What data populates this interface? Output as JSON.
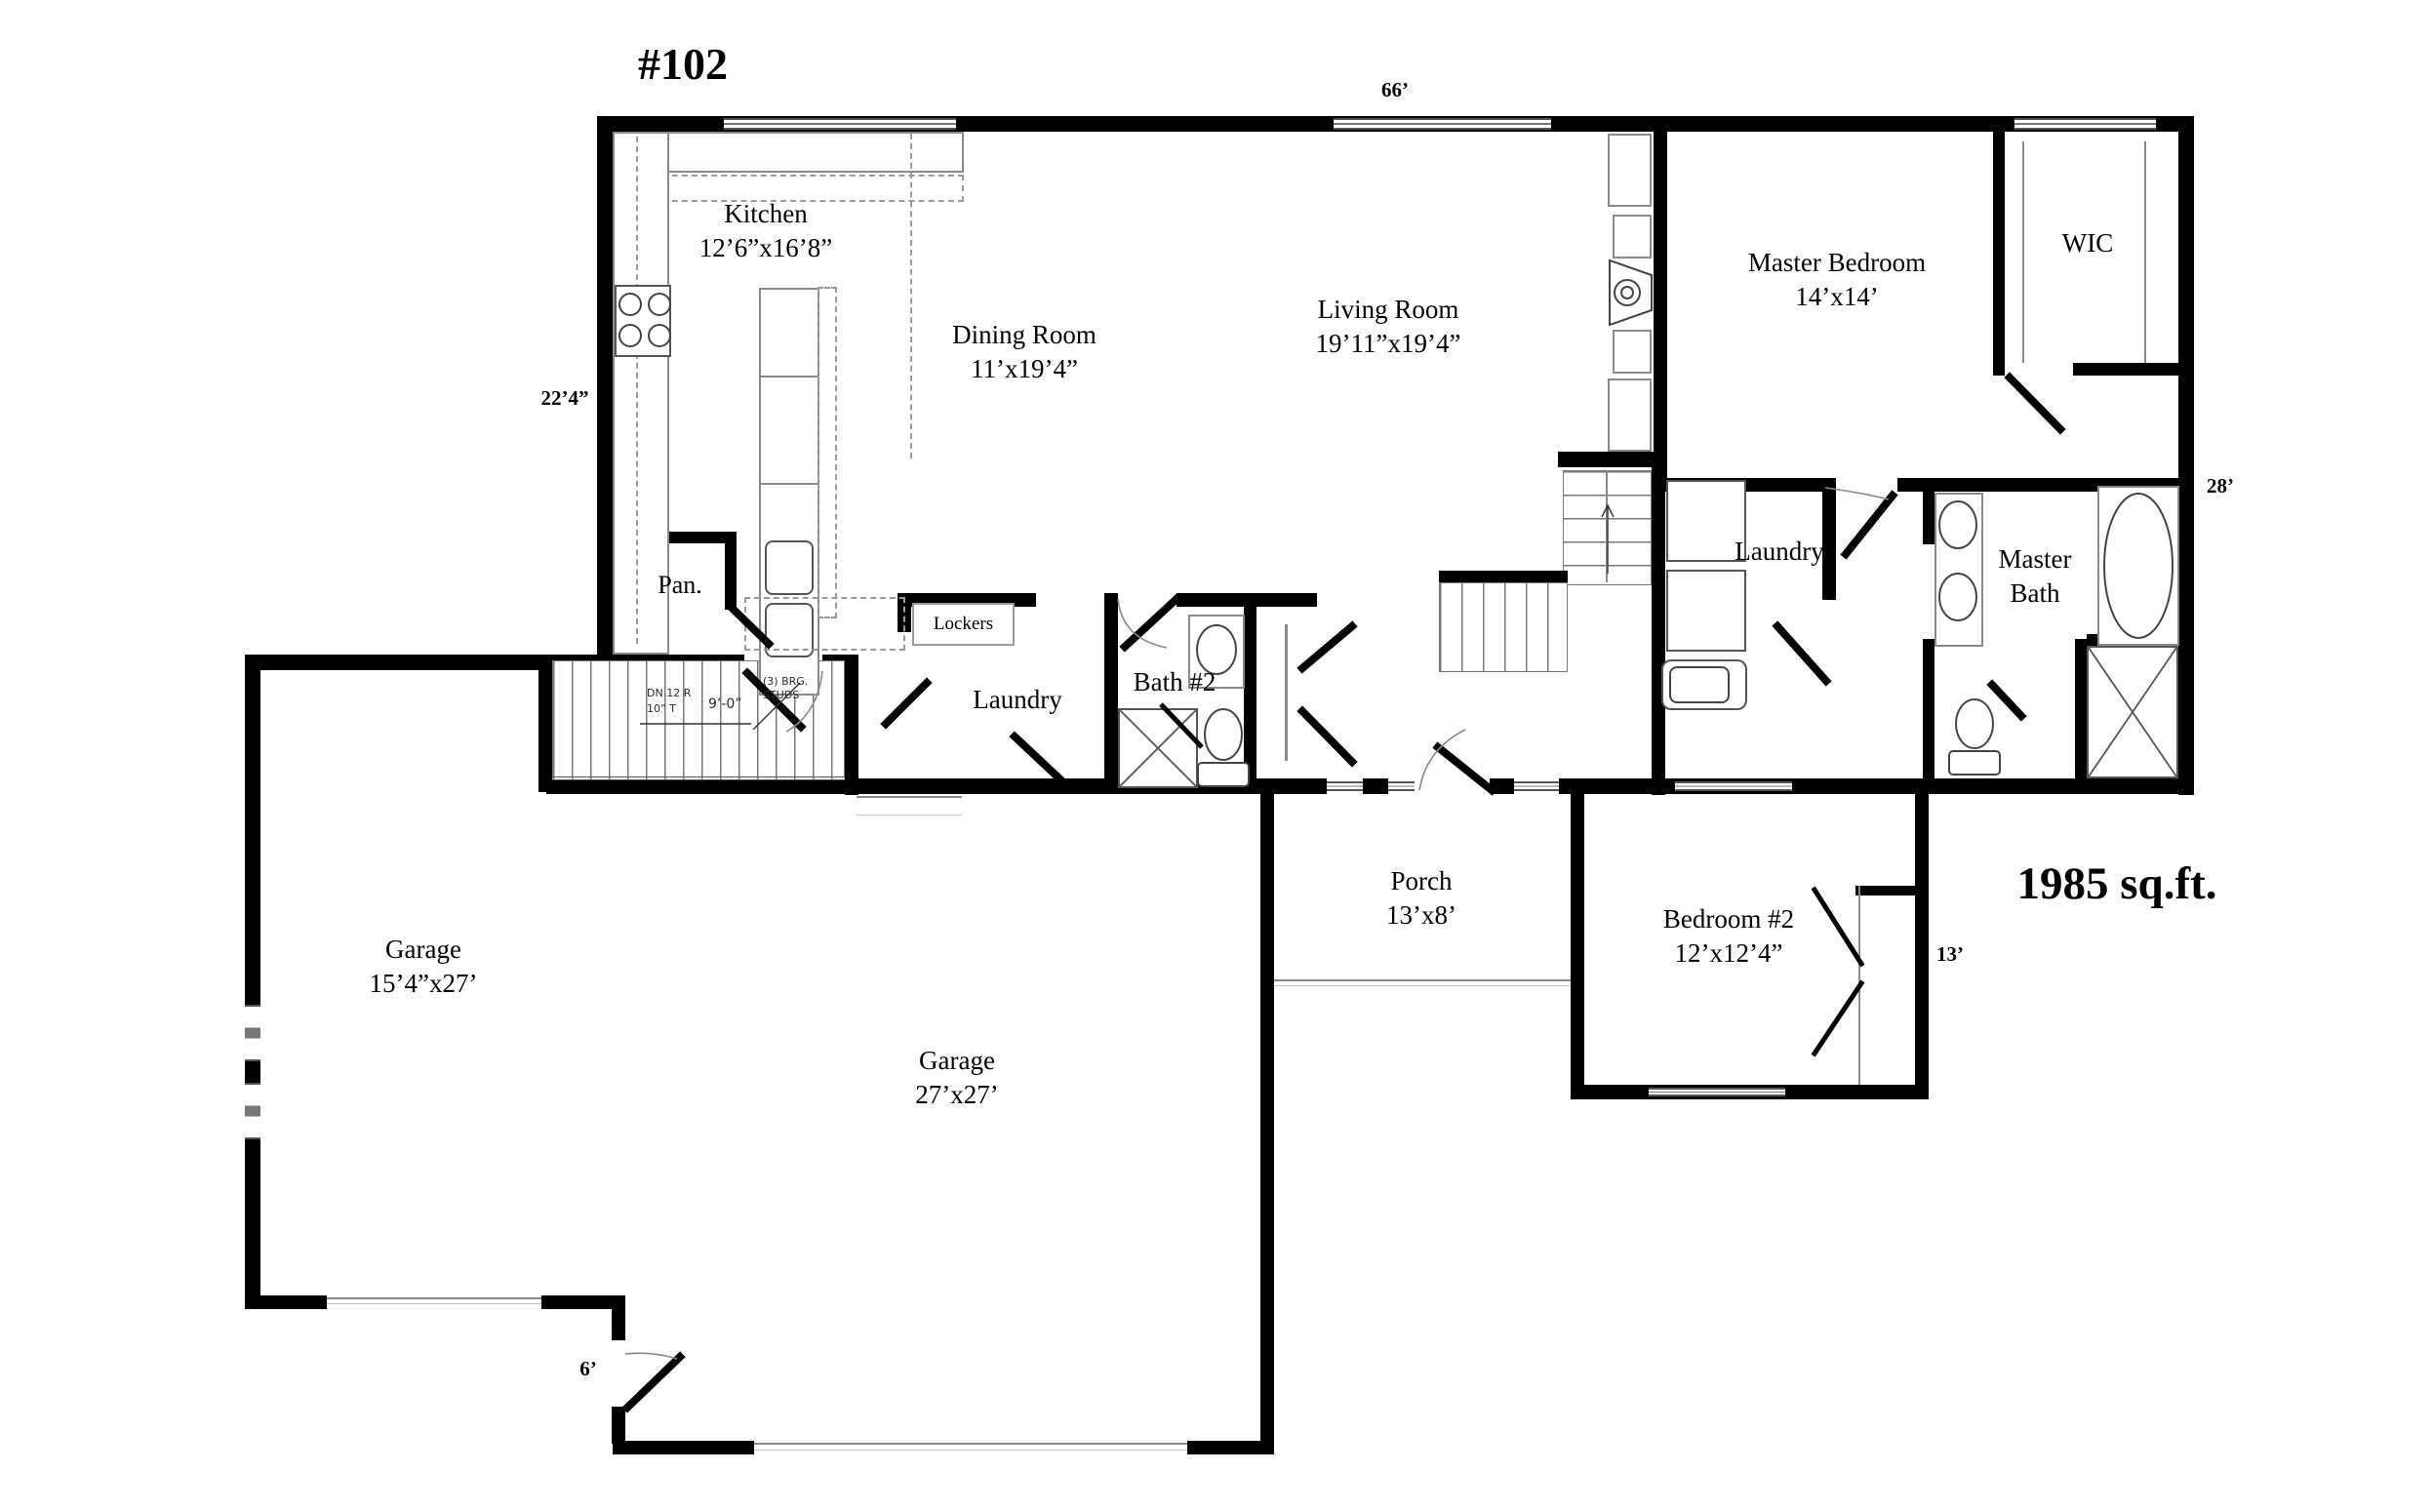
{
  "plan": {
    "title": "#102",
    "total_area": "1985 sq.ft.",
    "rooms": {
      "kitchen": {
        "name": "Kitchen",
        "dims": "12’6”x16’8”"
      },
      "dining": {
        "name": "Dining Room",
        "dims": "11’x19’4”"
      },
      "living": {
        "name": "Living Room",
        "dims": "19’11”x19’4”"
      },
      "master_bedroom": {
        "name": "Master Bedroom",
        "dims": "14’x14’"
      },
      "wic": {
        "name": "WIC"
      },
      "laundry_upper": {
        "name": "Laundry"
      },
      "master_bath": {
        "line1": "Master",
        "line2": "Bath"
      },
      "pantry": {
        "name": "Pan."
      },
      "lockers": {
        "name": "Lockers"
      },
      "laundry_main": {
        "name": "Laundry"
      },
      "bath2": {
        "name": "Bath #2"
      },
      "porch": {
        "name": "Porch",
        "dims": "13’x8’"
      },
      "bedroom2": {
        "name": "Bedroom #2",
        "dims": "12’x12’4”"
      },
      "garage_single": {
        "name": "Garage",
        "dims": "15’4”x27’"
      },
      "garage_main": {
        "name": "Garage",
        "dims": "27’x27’"
      }
    },
    "dimensions": {
      "top_width": "66’",
      "left_depth": "22’4”",
      "right_depth": "28’",
      "bedroom2_depth": "13’",
      "garage_service_door": "6’"
    },
    "stair_notes": {
      "down": "DN 12 R",
      "tread": "10” T",
      "width": "9’-0”",
      "bearing1": "(3) BRG.",
      "bearing2": "STUDS"
    },
    "wall_color": "#000000",
    "line_color": "#8a8a8a"
  }
}
